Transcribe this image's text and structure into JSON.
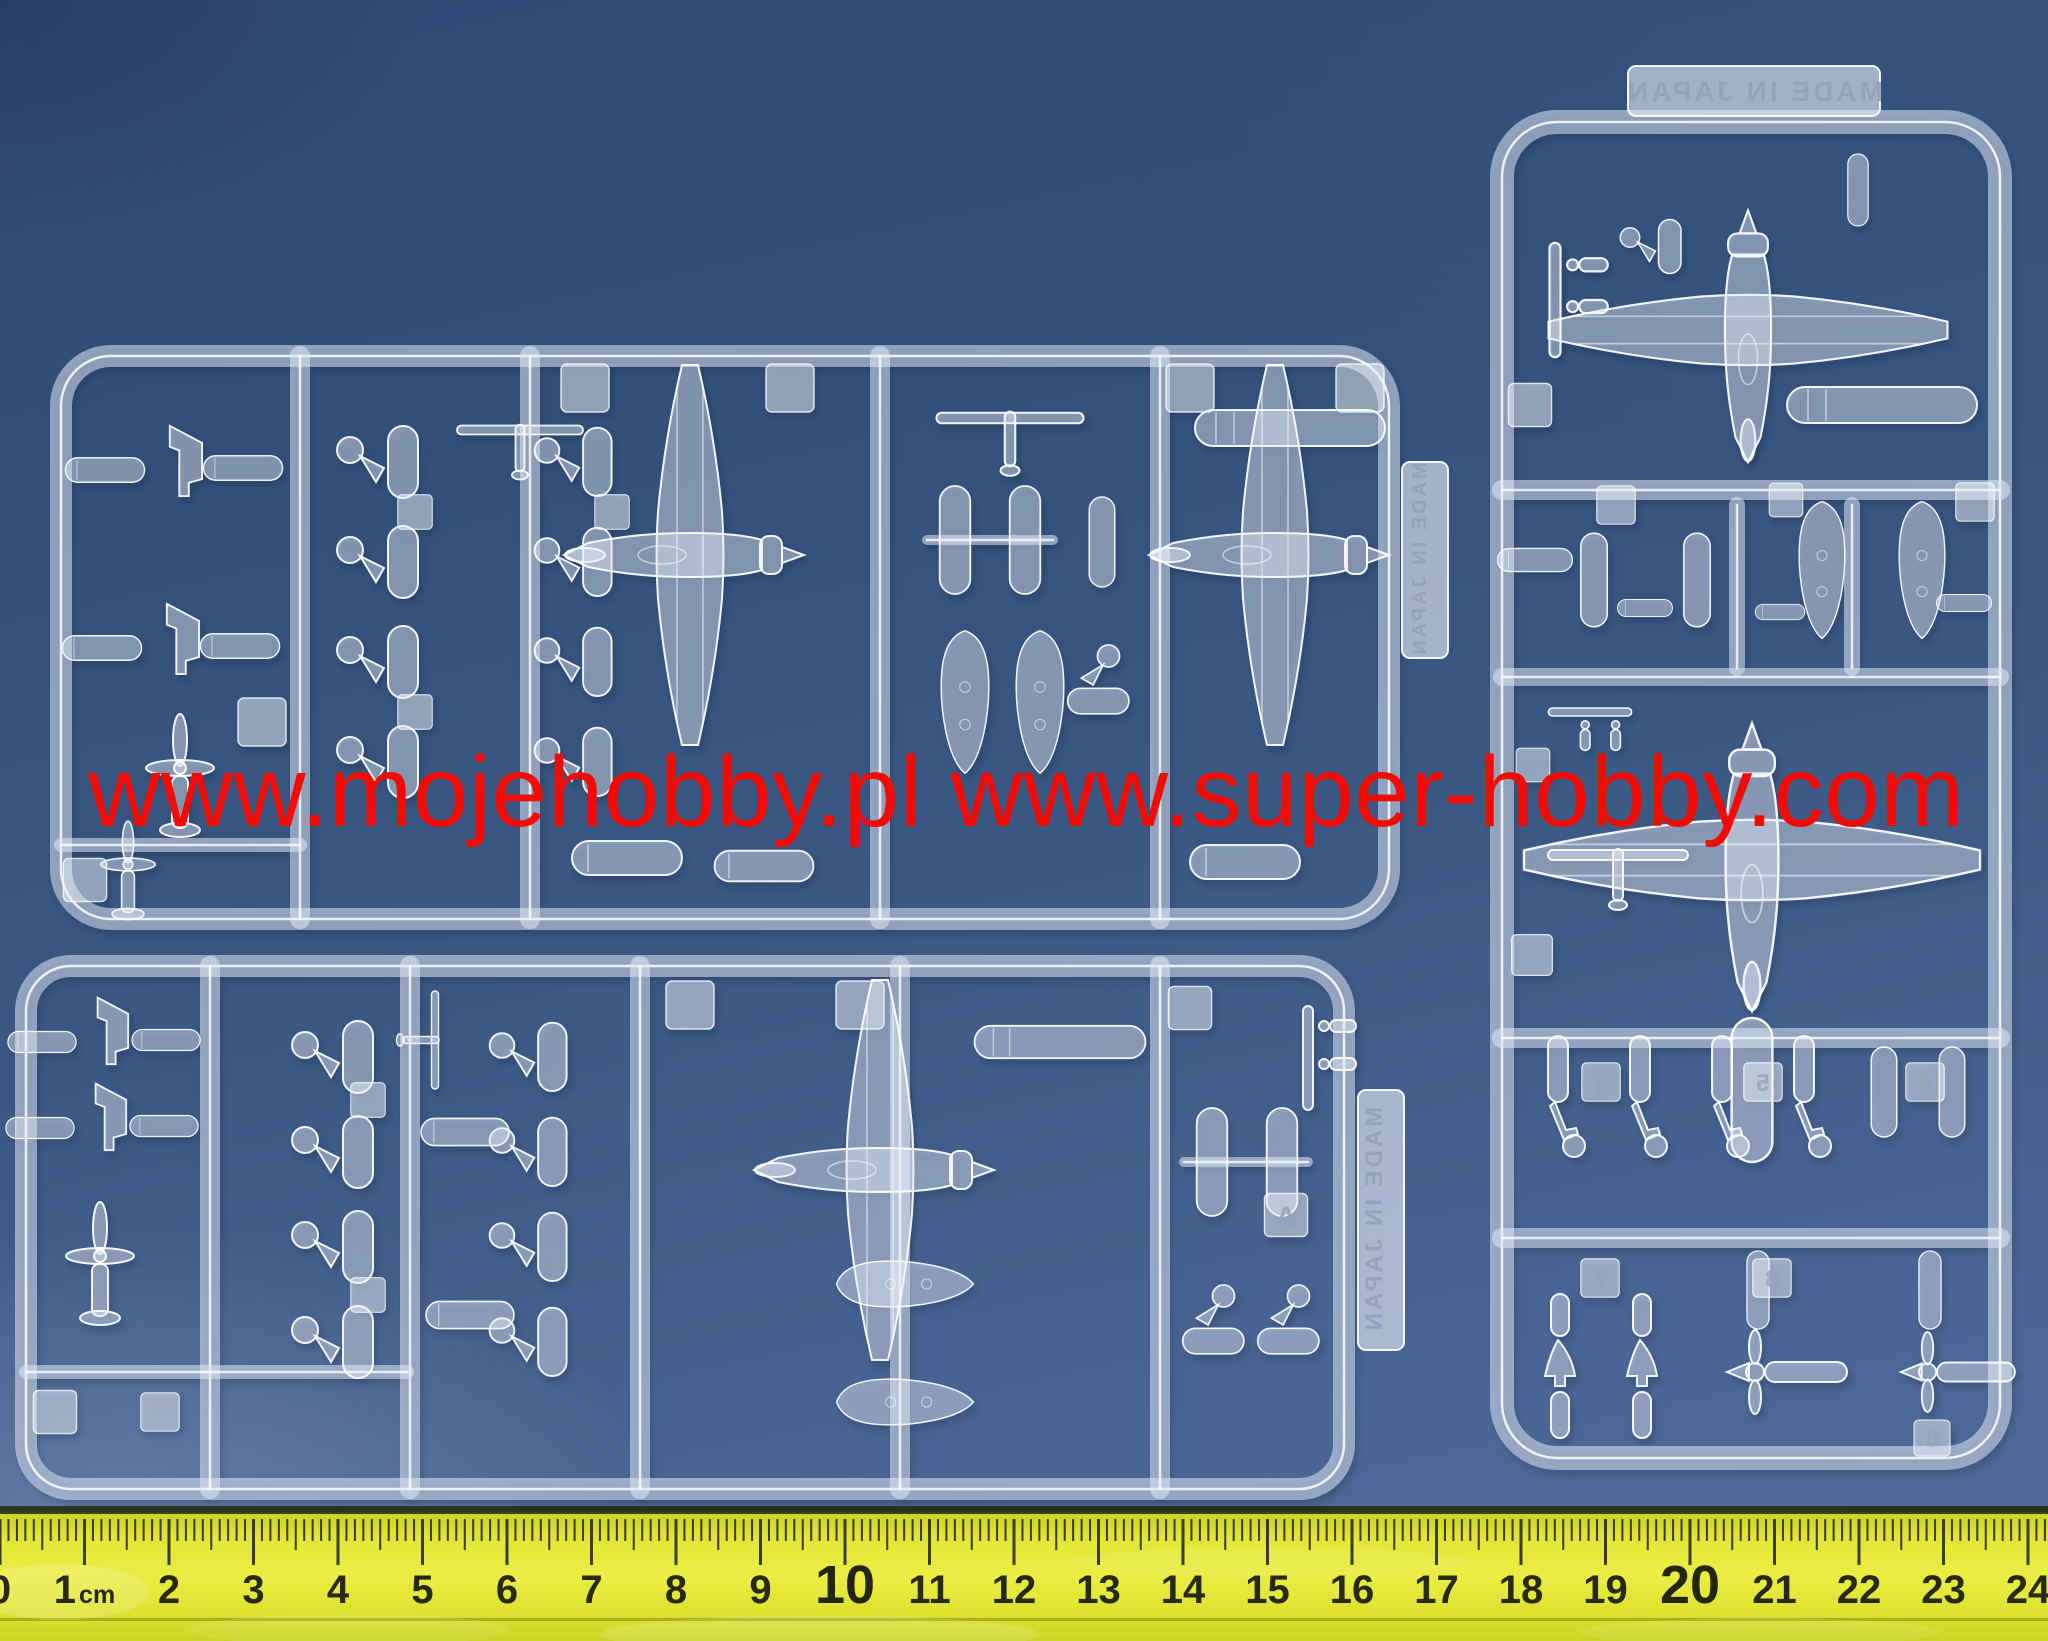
{
  "watermark": {
    "text": "www.mojehobby.pl www.super-hobby.com",
    "color": "#f30b00"
  },
  "sprues": {
    "made_in_japan": "MADE IN JAPAN",
    "part_number_tags": [
      "4",
      "5",
      "6",
      "7",
      "8",
      "8"
    ],
    "part_letter_tags": [
      "A"
    ],
    "plastic_color": "#edf3fa"
  },
  "ruler": {
    "unit": "cm",
    "numbers": [
      "0",
      "1",
      "2",
      "3",
      "4",
      "5",
      "6",
      "7",
      "8",
      "9",
      "10",
      "11",
      "12",
      "13",
      "14",
      "15",
      "16",
      "17",
      "18",
      "19",
      "20",
      "21",
      "22",
      "23",
      "24"
    ],
    "emphasized": [
      "10",
      "20"
    ],
    "color": "#e6e93a",
    "tick_color": "#2b3018"
  },
  "background_color": "#3a5884"
}
